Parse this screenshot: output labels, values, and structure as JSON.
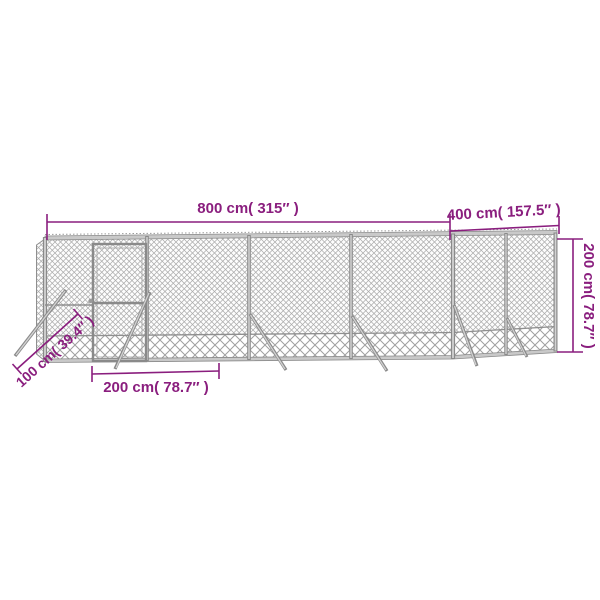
{
  "diagram": {
    "subject": "chain-link mesh outdoor enclosure with door, shown in perspective with dimension annotations",
    "dimensions": {
      "length": "800 cm( 315″ )",
      "depth": "400 cm( 157.5″ )",
      "height": "200 cm( 78.7″ )",
      "door_section_width": "200 cm( 78.7″ )",
      "brace_length": "100 cm( 39.4″ )"
    },
    "colors": {
      "dimension_annotation": "#8a1e7e",
      "fence_gray": "#8c8c8c",
      "mesh_gray": "#ababab",
      "background": "#ffffff"
    }
  }
}
